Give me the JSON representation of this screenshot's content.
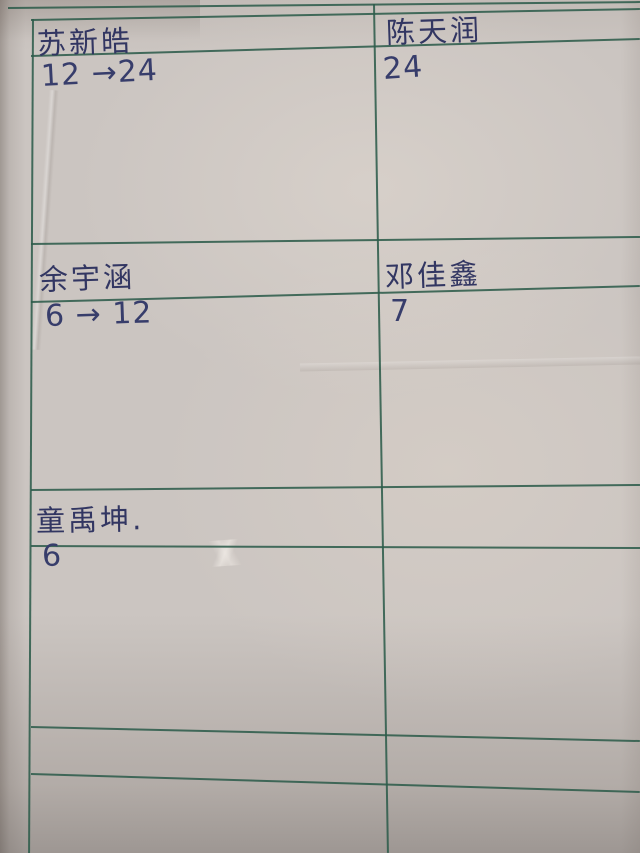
{
  "colors": {
    "paper": "#cbc5c1",
    "grid_line": "#2d5c4b",
    "ink": "#323662"
  },
  "table": {
    "columns": 2,
    "rows": [
      {
        "cells": [
          {
            "name": "苏新皓",
            "value": "12 →24"
          },
          {
            "name": "陈天润",
            "value": "24"
          }
        ]
      },
      {
        "cells": [
          {
            "name": "余宇涵",
            "value": "6 → 12"
          },
          {
            "name": "邓佳鑫",
            "value": "7"
          }
        ]
      },
      {
        "cells": [
          {
            "name": "童禹坤.",
            "value": "6"
          },
          {
            "name": "",
            "value": ""
          }
        ]
      },
      {
        "cells": [
          {
            "name": "",
            "value": ""
          },
          {
            "name": "",
            "value": ""
          }
        ]
      }
    ]
  }
}
